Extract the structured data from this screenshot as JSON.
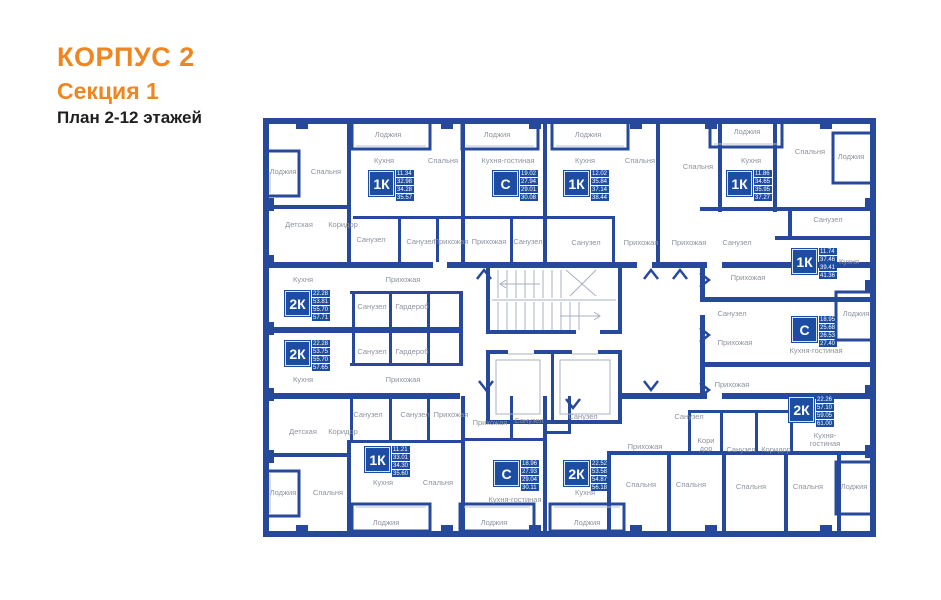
{
  "header": {
    "building": "КОРПУС 2",
    "section": "Секция 1",
    "plan": "План 2-12 этажей"
  },
  "colors": {
    "accent_orange": "#ee8622",
    "wall_blue": "#27499b",
    "badge_blue": "#1d4da3",
    "label_gray": "#8d93a0"
  },
  "apartments": [
    {
      "type": "1К",
      "areas": [
        "11.34",
        "32.98",
        "34.28",
        "35.57"
      ],
      "x": 368,
      "y": 170
    },
    {
      "type": "С",
      "areas": [
        "19.02",
        "27.94",
        "29.01",
        "30.08"
      ],
      "x": 492,
      "y": 170
    },
    {
      "type": "1К",
      "areas": [
        "12.02",
        "35.84",
        "37.14",
        "38.44"
      ],
      "x": 563,
      "y": 170
    },
    {
      "type": "1К",
      "areas": [
        "11.86",
        "34.65",
        "35.95",
        "37.27"
      ],
      "x": 726,
      "y": 170
    },
    {
      "type": "1К",
      "areas": [
        "11.74",
        "37.46",
        "39.41",
        "41.36"
      ],
      "x": 791,
      "y": 248
    },
    {
      "type": "С",
      "areas": [
        "18.95",
        "25.68",
        "26.53",
        "27.40"
      ],
      "x": 791,
      "y": 316
    },
    {
      "type": "2К",
      "areas": [
        "22.26",
        "57.10",
        "59.05",
        "61.00"
      ],
      "x": 788,
      "y": 396
    },
    {
      "type": "2К",
      "areas": [
        "22.28",
        "53.81",
        "55.70",
        "57.71"
      ],
      "x": 284,
      "y": 290
    },
    {
      "type": "2К",
      "areas": [
        "22.28",
        "53.75",
        "55.70",
        "57.65"
      ],
      "x": 284,
      "y": 340
    },
    {
      "type": "1К",
      "areas": [
        "11.21",
        "33.01",
        "34.30",
        "35.60"
      ],
      "x": 364,
      "y": 446
    },
    {
      "type": "С",
      "areas": [
        "18.96",
        "27.93",
        "29.04",
        "30.11"
      ],
      "x": 493,
      "y": 460
    },
    {
      "type": "2К",
      "areas": [
        "22.52",
        "53.58",
        "54.87",
        "56.18"
      ],
      "x": 563,
      "y": 460
    }
  ],
  "room_labels": [
    {
      "text": "Лоджия",
      "x": 283,
      "y": 172
    },
    {
      "text": "Спальня",
      "x": 326,
      "y": 172
    },
    {
      "text": "Лоджия",
      "x": 388,
      "y": 135
    },
    {
      "text": "Кухня",
      "x": 384,
      "y": 161
    },
    {
      "text": "Спальня",
      "x": 443,
      "y": 161
    },
    {
      "text": "Детская",
      "x": 299,
      "y": 225
    },
    {
      "text": "Коридор",
      "x": 343,
      "y": 225
    },
    {
      "text": "Санузел",
      "x": 371,
      "y": 240
    },
    {
      "text": "Санузел",
      "x": 421,
      "y": 242
    },
    {
      "text": "Прихожая",
      "x": 451,
      "y": 242
    },
    {
      "text": "Лоджия",
      "x": 497,
      "y": 135
    },
    {
      "text": "Кухня-гостиная",
      "x": 508,
      "y": 161
    },
    {
      "text": "Прихожая",
      "x": 489,
      "y": 242
    },
    {
      "text": "Санузел",
      "x": 528,
      "y": 242
    },
    {
      "text": "Лоджия",
      "x": 588,
      "y": 135
    },
    {
      "text": "Кухня",
      "x": 585,
      "y": 161
    },
    {
      "text": "Спальня",
      "x": 640,
      "y": 161
    },
    {
      "text": "Санузел",
      "x": 586,
      "y": 243
    },
    {
      "text": "Прихожая",
      "x": 641,
      "y": 243
    },
    {
      "text": "Прихожая",
      "x": 689,
      "y": 243
    },
    {
      "text": "Санузел",
      "x": 737,
      "y": 243
    },
    {
      "text": "Спальня",
      "x": 698,
      "y": 167
    },
    {
      "text": "Лоджия",
      "x": 747,
      "y": 132
    },
    {
      "text": "Кухня",
      "x": 751,
      "y": 161
    },
    {
      "text": "Спальня",
      "x": 810,
      "y": 152
    },
    {
      "text": "Лоджия",
      "x": 851,
      "y": 157
    },
    {
      "text": "Санузел",
      "x": 828,
      "y": 220
    },
    {
      "text": "Прихожая",
      "x": 748,
      "y": 278
    },
    {
      "text": "Кухня",
      "x": 849,
      "y": 262
    },
    {
      "text": "Санузел",
      "x": 732,
      "y": 314
    },
    {
      "text": "Прихожая",
      "x": 735,
      "y": 343
    },
    {
      "text": "Лоджия",
      "x": 856,
      "y": 314
    },
    {
      "text": "Кухня-гостиная",
      "x": 816,
      "y": 351
    },
    {
      "text": "Прихожая",
      "x": 732,
      "y": 385
    },
    {
      "text": "Кухня",
      "x": 303,
      "y": 280
    },
    {
      "text": "Прихожая",
      "x": 403,
      "y": 280
    },
    {
      "text": "Санузел",
      "x": 372,
      "y": 307
    },
    {
      "text": "Гардероб",
      "x": 412,
      "y": 307
    },
    {
      "text": "Санузел",
      "x": 372,
      "y": 352
    },
    {
      "text": "Гардероб",
      "x": 412,
      "y": 352
    },
    {
      "text": "Кухня",
      "x": 303,
      "y": 380
    },
    {
      "text": "Прихожая",
      "x": 403,
      "y": 380
    },
    {
      "text": "Санузел",
      "x": 368,
      "y": 415
    },
    {
      "text": "Санузел",
      "x": 415,
      "y": 415
    },
    {
      "text": "Прихожая",
      "x": 451,
      "y": 415
    },
    {
      "text": "Детская",
      "x": 303,
      "y": 432
    },
    {
      "text": "Коридор",
      "x": 343,
      "y": 432
    },
    {
      "text": "Кухня",
      "x": 383,
      "y": 483
    },
    {
      "text": "Спальня",
      "x": 328,
      "y": 493
    },
    {
      "text": "Лоджия",
      "x": 283,
      "y": 493
    },
    {
      "text": "Лоджия",
      "x": 386,
      "y": 523
    },
    {
      "text": "Спальня",
      "x": 438,
      "y": 483
    },
    {
      "text": "Прихожая",
      "x": 490,
      "y": 423
    },
    {
      "text": "Санузел",
      "x": 529,
      "y": 421
    },
    {
      "text": "Санузел",
      "x": 583,
      "y": 417
    },
    {
      "text": "Прихожая",
      "x": 645,
      "y": 447
    },
    {
      "text": "Санузел",
      "x": 689,
      "y": 417
    },
    {
      "text": "Кухня-гостиная",
      "x": 515,
      "y": 500
    },
    {
      "text": "Лоджия",
      "x": 494,
      "y": 523
    },
    {
      "text": "Кухня",
      "x": 585,
      "y": 493
    },
    {
      "text": "Лоджия",
      "x": 587,
      "y": 523
    },
    {
      "text": "Спальня",
      "x": 641,
      "y": 485
    },
    {
      "text": "Спальня",
      "x": 691,
      "y": 485
    },
    {
      "text": "Спальня",
      "x": 751,
      "y": 487
    },
    {
      "text": "Спальня",
      "x": 808,
      "y": 487
    },
    {
      "text": "Лоджия",
      "x": 854,
      "y": 487
    },
    {
      "text": "Кори дор",
      "x": 706,
      "y": 445,
      "w": 24
    },
    {
      "text": "Санузел",
      "x": 741,
      "y": 450
    },
    {
      "text": "Коридор",
      "x": 776,
      "y": 450
    },
    {
      "text": "Кухня-гостиная",
      "x": 825,
      "y": 440,
      "w": 44
    }
  ]
}
